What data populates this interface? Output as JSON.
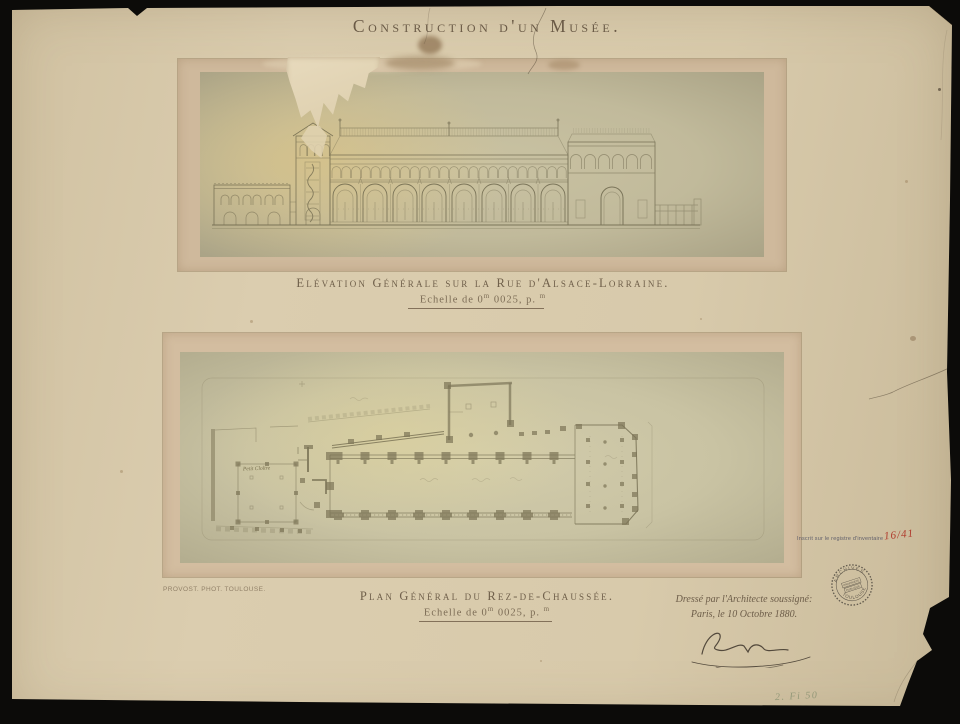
{
  "document": {
    "title": "Construction d'un Musée."
  },
  "figures": {
    "elevation": {
      "caption": "Elévation Générale sur la Rue d'Alsace-Lorraine.",
      "scale_pre": "Echelle de 0",
      "scale_sup1": "m",
      "scale_mid": " 0025, p. ",
      "scale_sup2": "m"
    },
    "plan": {
      "caption": "Plan Général du Rez-de-Chaussée.",
      "scale_pre": "Echelle de 0",
      "scale_sup1": "m",
      "scale_mid": " 0025, p. ",
      "scale_sup2": "m",
      "room_label": "Petit Cloître"
    }
  },
  "annotations": {
    "photographer_credit": "PROVOST. PHOT. TOULOUSE.",
    "architect_line1": "Dressé par l'Architecte soussigné:",
    "architect_line2": "Paris, le 10 Octobre 1880.",
    "inventory_note": "Inscrit sur le registre d'inventaire",
    "inventory_number": "16/41",
    "shelfmark": "2. Fi 50"
  },
  "stamp": {
    "arc_top": "ARCHIVES",
    "line1": "PROPRIÉTÉ",
    "line2": "PUBLIQUE",
    "arc_bottom": "TOULOUSE"
  },
  "colors": {
    "background": "#0c0b09",
    "paper": "#d8caab",
    "mount": "#cfb99c",
    "photo_elevation": "#c5bd9d",
    "photo_plan": "#ccc6a6",
    "ink": "#6a5a46",
    "red_ink": "#b03a2c",
    "pencil_green": "#8a9272",
    "stamp_ink": "#4b453c"
  }
}
